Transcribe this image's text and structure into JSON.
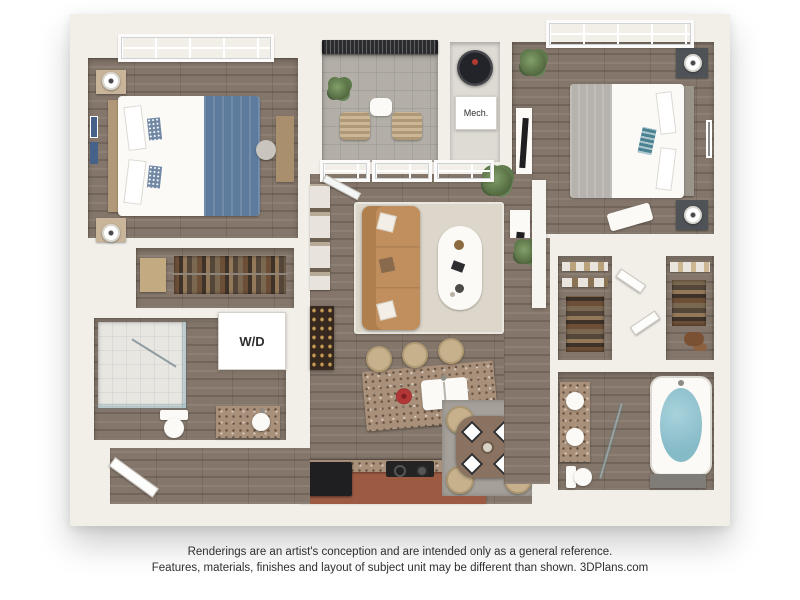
{
  "labels": {
    "mech": "Mech.",
    "washer_dryer": "W/D"
  },
  "disclaimer": {
    "line1": "Renderings are an artist's conception and are intended only as a general reference.",
    "line2": "Features, materials, finishes and layout of subject unit may be different than shown.",
    "brand": "3DPlans.com"
  },
  "colors": {
    "wall": "#f2efe9",
    "woodFloor": "#84766a",
    "balconyTile": "#b3afa8",
    "railingDark": "#2c2c2e",
    "sofaTan": "#c18f5e",
    "bed1Blue": "#5d7b9d",
    "bed2Gray": "#b6b3ae",
    "tealPillow": "#4a8292",
    "cabinetTerracotta": "#9c5a43",
    "graniteTop": "#a8907a",
    "tubWater": "#85bac7",
    "livingRug": "#ddd7cb",
    "diningRug": "#a5a099",
    "plantGreen": "#51673e",
    "applianceDark": "#1f1f22",
    "fixtureWhite": "#fbfaf7",
    "stoolBeige": "#c6b18c",
    "textDark": "#2f2f2f"
  }
}
